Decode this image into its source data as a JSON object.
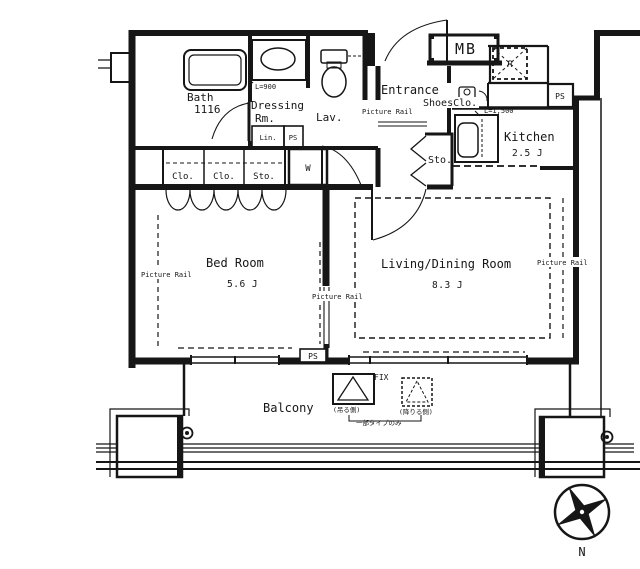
{
  "plan": {
    "bath": {
      "name": "Bath",
      "dim": "1116"
    },
    "dressing": {
      "name": "Dressing",
      "name2": "Rm."
    },
    "lav": {
      "name": "Lav."
    },
    "entrance": {
      "name": "Entrance"
    },
    "shoes_closet": {
      "name": "ShoesClo."
    },
    "meter_box": {
      "name": "MB"
    },
    "refrigerator": {
      "name": "R"
    },
    "pipe_shafts": {
      "ps_top": "PS",
      "ps_lin": "PS",
      "ps_bedroom": "PS"
    },
    "linen": {
      "name": "Lin."
    },
    "washer": {
      "name": "W"
    },
    "closets": {
      "clo1": "Clo.",
      "clo2": "Clo.",
      "sto": "Sto."
    },
    "storage_hall": {
      "name": "Sto."
    },
    "kitchen": {
      "name": "Kitchen",
      "size": "2.5 J",
      "counter_dim": "L=1,500"
    },
    "basin_dim": "L=900",
    "bedroom": {
      "name": "Bed Room",
      "size": "5.6 J"
    },
    "living": {
      "name": "Living/Dining Room",
      "size": "8.3 J"
    },
    "balcony": {
      "name": "Balcony"
    },
    "window_fix": "FIX",
    "picture_rail": {
      "left": "Picture Rail",
      "hall": "Picture Rail",
      "center": "Picture Rail",
      "right": "Picture Rail"
    },
    "hatch": {
      "solid_label": "(吊る側)",
      "dashed_label": "(降りる側)",
      "note": "一部タイプのみ"
    },
    "compass": {
      "n": "N"
    }
  }
}
